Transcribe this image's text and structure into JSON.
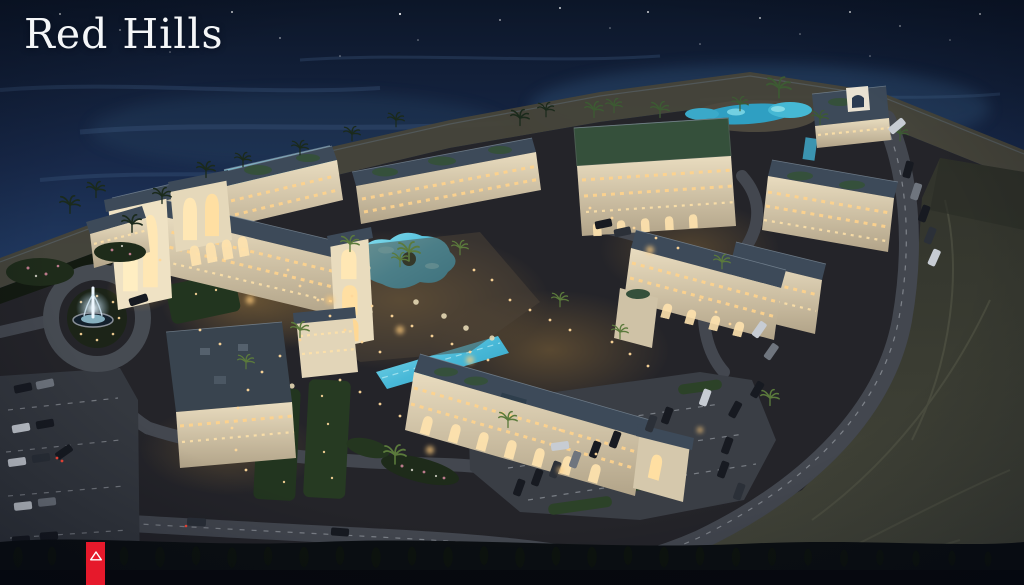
{
  "page": {
    "title": "Red Hills"
  },
  "logo": {
    "text": "Red Hills"
  },
  "ribbon": {
    "icon": "mountain-triangle-icon"
  },
  "palette": {
    "brand_red": "#e6192b",
    "logo_white": "#f4f6f8",
    "sea_top": "#0c1628",
    "sea_mid": "#1c3050",
    "sea_deep": "#2c4a6e",
    "beach_sand": "#474439",
    "vegetation_dark": "#131a10",
    "ground": "#242429",
    "desert": "#3c3e33",
    "road_asphalt": "#43474f",
    "road_marking": "#c8ccd2",
    "building_wall": "#d9cdb4",
    "building_wall_lit": "#f2e5c6",
    "roof_slate": "#3d4a59",
    "roof_green": "#35503b",
    "window_warm": "#ffd38c",
    "pool_deep": "#2f9fc2",
    "pool_bright": "#7fdcea",
    "fountain_glow": "#dceeff",
    "car_light": "#c7ccd3",
    "car_dark": "#171a21",
    "tree_dark": "#0c110d",
    "flower_pink": "#d98aa0"
  },
  "scene": {
    "caption": "Aerial night render of a seaside resort: white low-rise buildings with lit arched facades around turquoise pools, a lit fountain roundabout at left, parking lots with cars, a curving perimeter road, beach lagoon and dark sea at top, desert terrain at lower right."
  }
}
